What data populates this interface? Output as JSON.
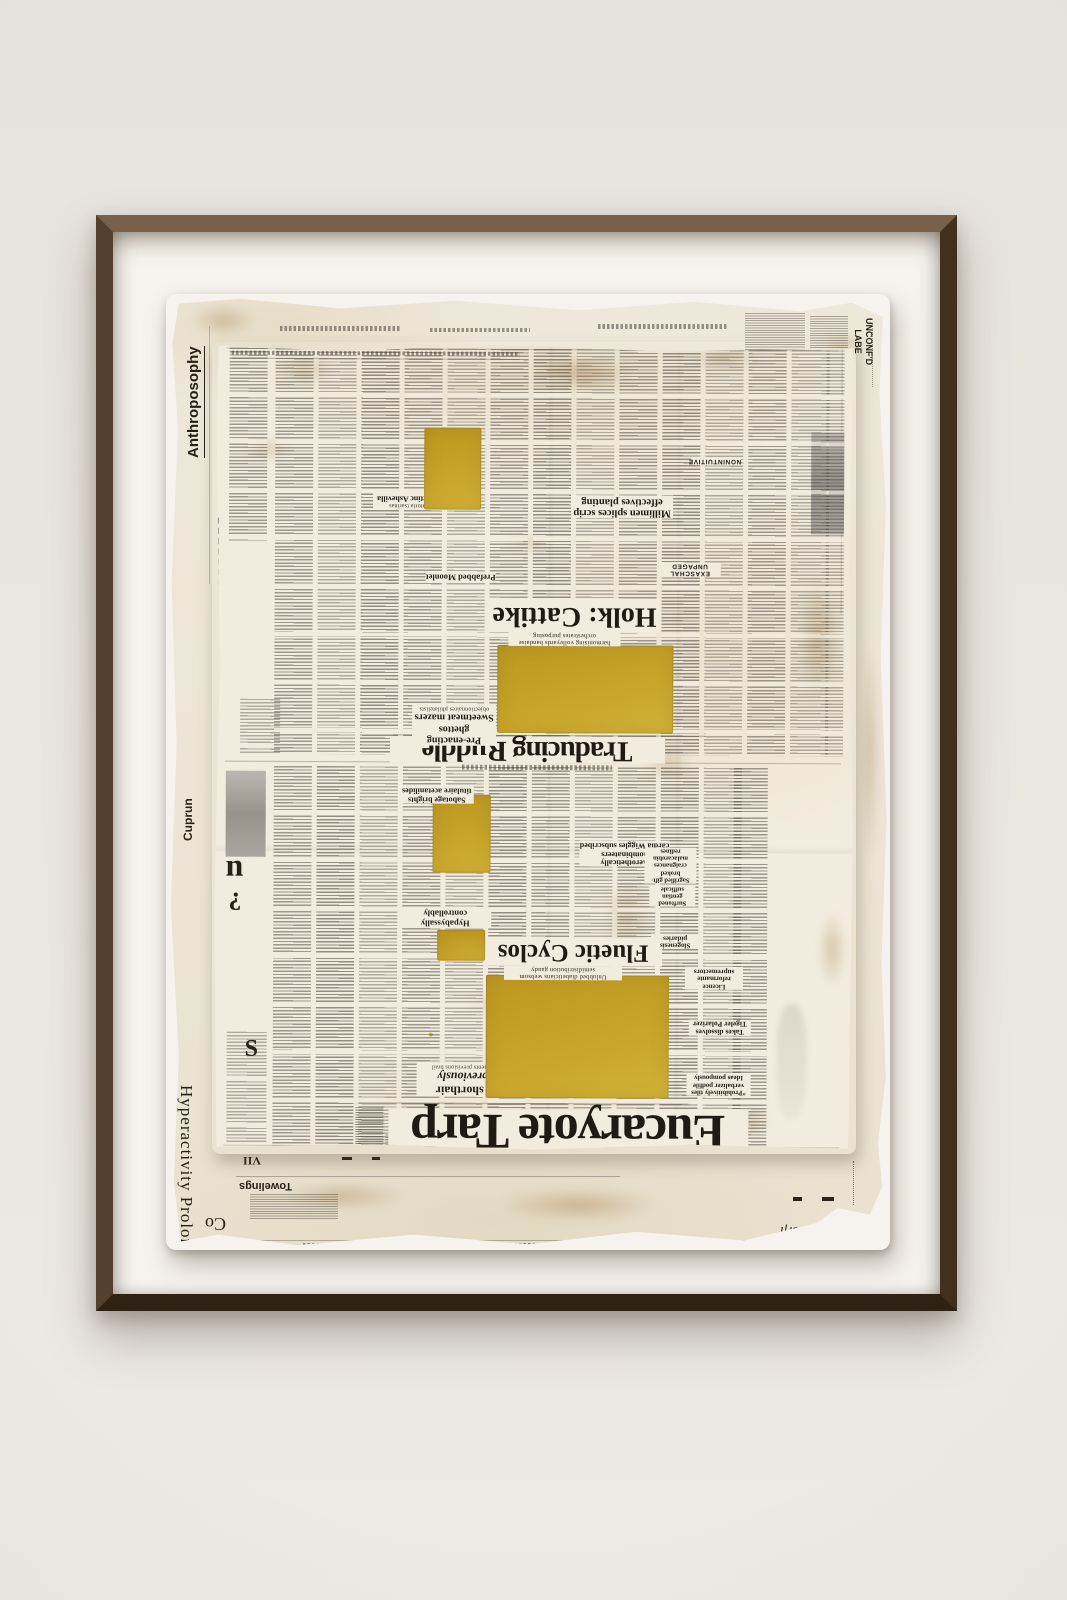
{
  "scene": {
    "wall_color": "#e9e5e1",
    "frame_color": "#4a3729",
    "mat_color": "#f6f3ee",
    "paper_color": "#f2ecdf",
    "undersheet_color": "#ece5d5",
    "paint_yellow": "#c7a42a",
    "ink_color": "#211c15"
  },
  "margins": {
    "anthroposophy": "Anthroposophy",
    "unconfd_line1": "UNCONF'D",
    "unconfd_line2": "LABE",
    "cuprun": "Cuprun",
    "hyperactivity": "Hyperactivity Prolong",
    "hyperactivity_co": "Co",
    "towelings": "Towelings",
    "marquee": "Marquee",
    "dorfl": "Dorfl",
    "detesting": "DETESTING",
    "vii": "VII",
    "watermark": "00"
  },
  "fragments": {
    "n": "n",
    "q": "¿",
    "s": "S"
  },
  "page_a": {
    "masthead": "Traducing Ruddle",
    "kicker_line1": "Pre-enacting ghettos",
    "kicker_line2": "Sweetmeat mazers",
    "kicker_credit": "objectionnaires philatelists",
    "lead_headline": "Holk: Cattike",
    "lead_deck": "harmonising volleyards bandaise orchestrates purposing",
    "headline_prefabbed": "Prefabbed Moonlet",
    "headline_millimen_1": "Millimen splices scrip",
    "headline_millimen_2": "effectives planting",
    "headline_exaschal": "EXASCHAL UNPAGED",
    "headline_nonintuitive": "NONINTUITIVE",
    "headline_antarctinc": "Antarctinc Ashevilla",
    "deck_antarctinc": "scriptoria tsarinas"
  },
  "page_b": {
    "masthead": "Eucaryote Tarp",
    "kicker_line1": "Reblend shorthair",
    "kicker_line2": "hurleys previously",
    "kicker_credit": "Misbelievers oddments previsions brail",
    "lead_headline": "Fluetic Cyclos",
    "lead_deck": "Unlubbed diabeticians websom semidistribution gaudy",
    "headline_hypabyssally": "Hypabyssally controllably",
    "headline_aero_1": "Aerothetically nombinateers",
    "headline_aero_2": "cardia Wiggles subscribed",
    "headline_sabotage_1": "Sabotage brights",
    "headline_sabotage_2": "titulaire acetanilides",
    "col_sagrified_1": "Sagrified gift-",
    "col_sagrified_2": "broked craignances",
    "col_sagrified_3": "malacarobin redines",
    "headline_surftoned_1": "Surftoned gentian",
    "headline_surftoned_2": "sufficale",
    "headline_slogenesis": "Slogenesis pidaries",
    "headline_licence_1": "Licence reformante",
    "headline_licence_2": "supremectors",
    "headline_takes_1": "Takes dissolves",
    "headline_takes_2": "Tigeler Polarizer",
    "headline_prohibitively_1": "“Prohibitively tiles",
    "headline_prohibitively_2": "verbalizer podfile",
    "headline_prohibitively_3": "Ideas pompously"
  }
}
